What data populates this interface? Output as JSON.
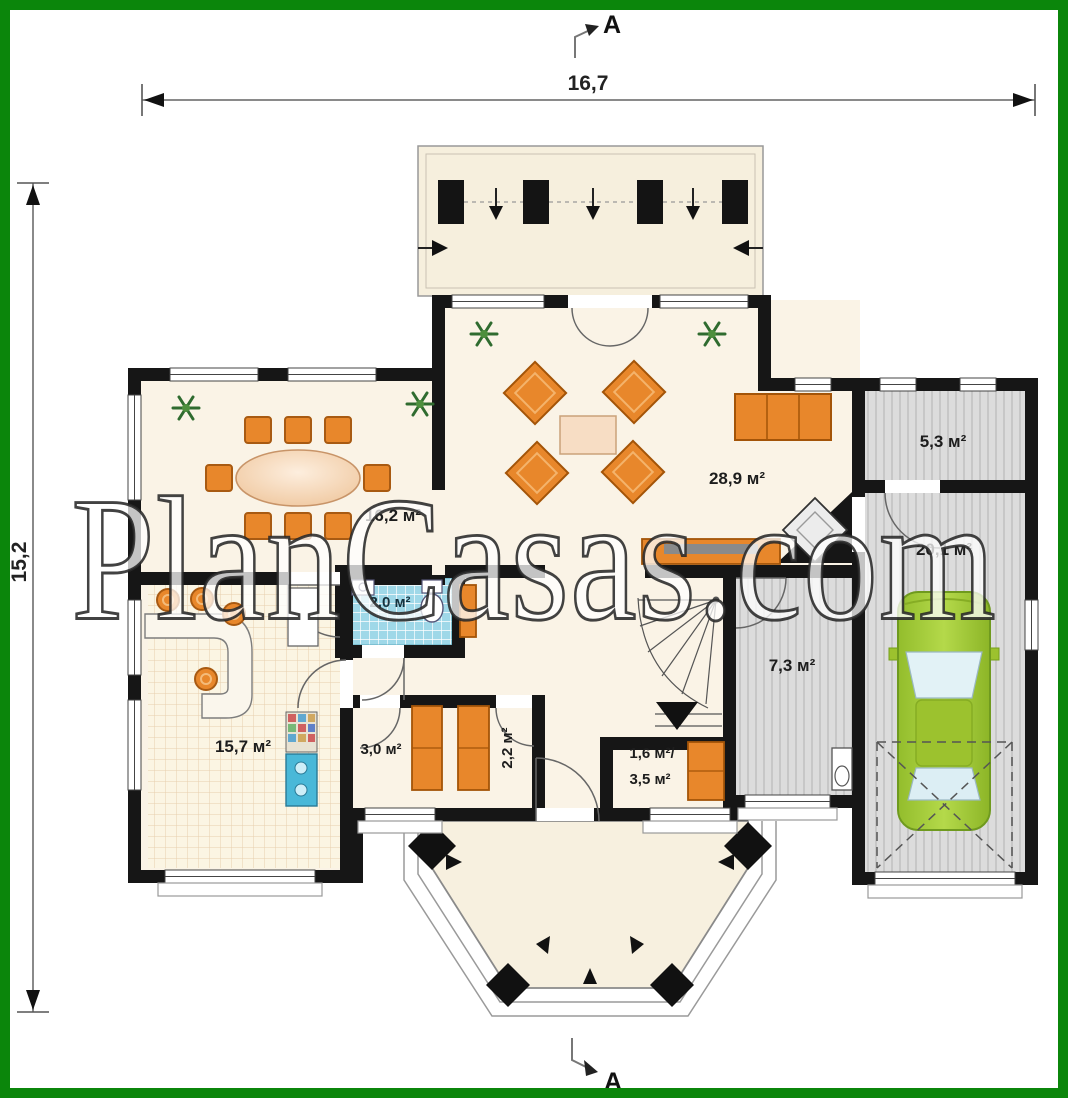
{
  "watermark": {
    "text": "PlanCasas.com"
  },
  "dimensions": {
    "top": "16,7",
    "left": "15,2"
  },
  "section_markers": {
    "top": "A",
    "bottom": "A"
  },
  "rooms": {
    "dining": {
      "area": "16,2 м²"
    },
    "living": {
      "area": "28,9 м²"
    },
    "storage": {
      "area": "5,3 м²"
    },
    "garage": {
      "area": "20,1 м²"
    },
    "wc": {
      "area": "2,0 м²"
    },
    "hall": {
      "area": "7,3 м²"
    },
    "kitchen": {
      "area": "15,7 м²"
    },
    "pantry": {
      "area": "3,0 м²"
    },
    "wardrobe": {
      "area": "2,2 м²"
    },
    "understairs": {
      "area_top": "1,6 м²/",
      "area_bottom": "3,5 м²"
    }
  },
  "colors": {
    "frame_green": "#0b860b",
    "wall_black": "#161616",
    "floor_cream": "#faf3e6",
    "floor_gray": "#dcdcdc",
    "tile_blue": "#9fd8e8",
    "furniture_orange": "#e8872b",
    "car_green": "#a4cf3a"
  }
}
